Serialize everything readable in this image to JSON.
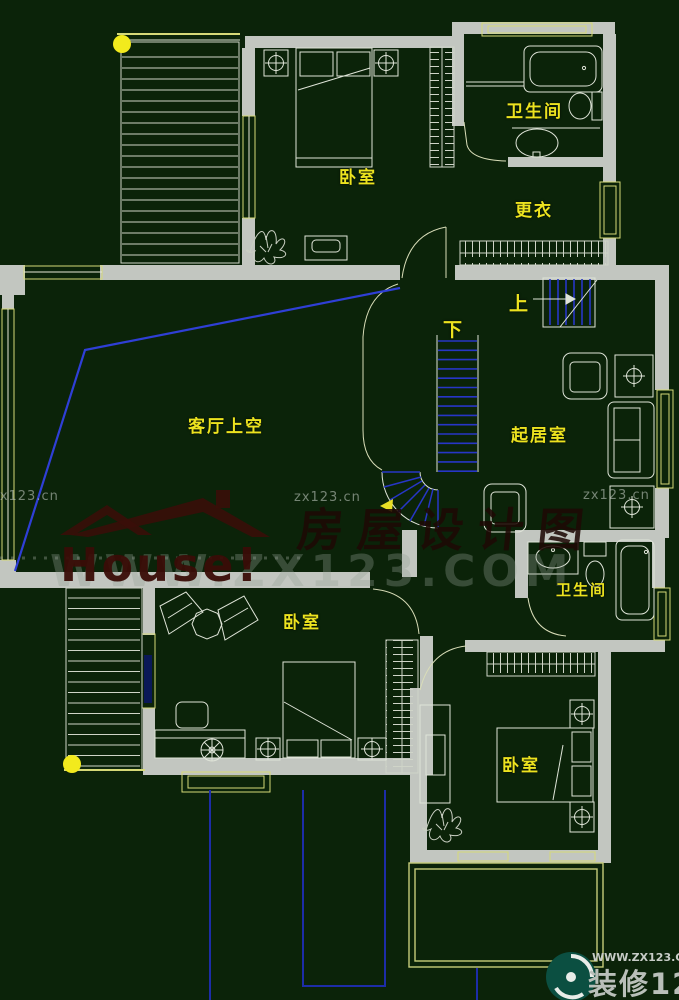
{
  "canvas": {
    "width": 679,
    "height": 1000,
    "background": "#0b2309"
  },
  "colors": {
    "wall": "#c2c6c0",
    "line": "#dfe4d8",
    "accent_yellow": "#d6d978",
    "label_yellow": "#ece31f",
    "stair_blue": "#2736c6",
    "void_blue": "#2f3fd6",
    "window_blue": "#0a1857",
    "dot_yellow": "#f2ea1d",
    "watermark_gray": "#bcc4bc",
    "watermark_red": "#3a0d07",
    "logo_teal": "#0b4f41"
  },
  "rooms": [
    {
      "id": "bedroom-top",
      "label": "卧室"
    },
    {
      "id": "bathroom-top",
      "label": "卫生间"
    },
    {
      "id": "dressing-room",
      "label": "更衣"
    },
    {
      "id": "living-void",
      "label": "客厅上空"
    },
    {
      "id": "sitting-room",
      "label": "起居室"
    },
    {
      "id": "bathroom-middle",
      "label": "卫生间"
    },
    {
      "id": "bedroom-middle",
      "label": "卧室"
    },
    {
      "id": "bedroom-bottom",
      "label": "卧室"
    }
  ],
  "stairs": {
    "up_label": "上",
    "down_label": "下"
  },
  "watermarks": {
    "site_small_left": "zx123.cn",
    "site_small_center": "zx123.cn",
    "site_small_right": "zx123.cn",
    "big_url": "WWW.ZX123.COM",
    "brand_text": "房屋设计图",
    "house_logo_text": "House!",
    "footer_url": "WWW.ZX123.CN",
    "footer_brand": "装修123"
  }
}
